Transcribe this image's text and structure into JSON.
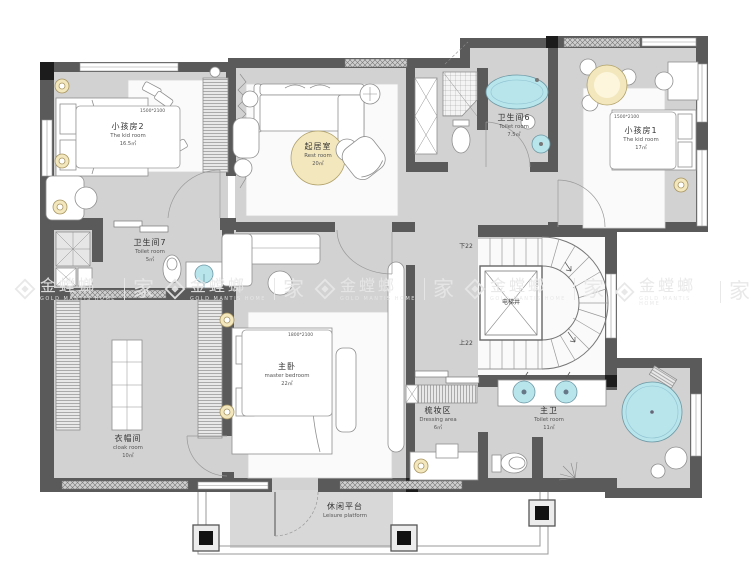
{
  "watermark": {
    "brand_cn": "金螳螂",
    "brand_en": "GOLD MANTIS HOME",
    "suffix_cn": "家"
  },
  "rooms": {
    "kid_room_2": {
      "name_cn": "小孩房2",
      "name_en": "The kid room",
      "area": "16.5㎡",
      "bed_size": "1500*2100"
    },
    "rest_room": {
      "name_cn": "起居室",
      "name_en": "Rest room",
      "area": "20㎡"
    },
    "toilet_6": {
      "name_cn": "卫生间6",
      "name_en": "Toilet room",
      "area": "7.5㎡"
    },
    "kid_room_1": {
      "name_cn": "小孩房1",
      "name_en": "The kid room",
      "area": "17㎡",
      "bed_size": "1500*2100"
    },
    "toilet_7": {
      "name_cn": "卫生间7",
      "name_en": "Toilet room",
      "area": "5㎡"
    },
    "master_bedroom": {
      "name_cn": "主卧",
      "name_en": "master bedroom",
      "area": "22㎡",
      "bed_size": "1800*2100"
    },
    "cloak_room": {
      "name_cn": "衣帽间",
      "name_en": "cloak room",
      "area": "10㎡"
    },
    "dressing_area": {
      "name_cn": "梳妆区",
      "name_en": "Dressing area",
      "area": "6㎡"
    },
    "master_toilet": {
      "name_cn": "主卫",
      "name_en": "Toilet room",
      "area": "11㎡"
    },
    "leisure_platform": {
      "name_cn": "休闲平台",
      "name_en": "Leisure platform"
    }
  },
  "stairs": {
    "down_label": "下22",
    "up_label": "上22",
    "elevator_label": "电梯井"
  },
  "colors": {
    "wall": "#5a5a5a",
    "floor": "#d2d2d2",
    "fixture_blue": "#b8e4ec",
    "accent_cream": "#f3e7bd"
  }
}
